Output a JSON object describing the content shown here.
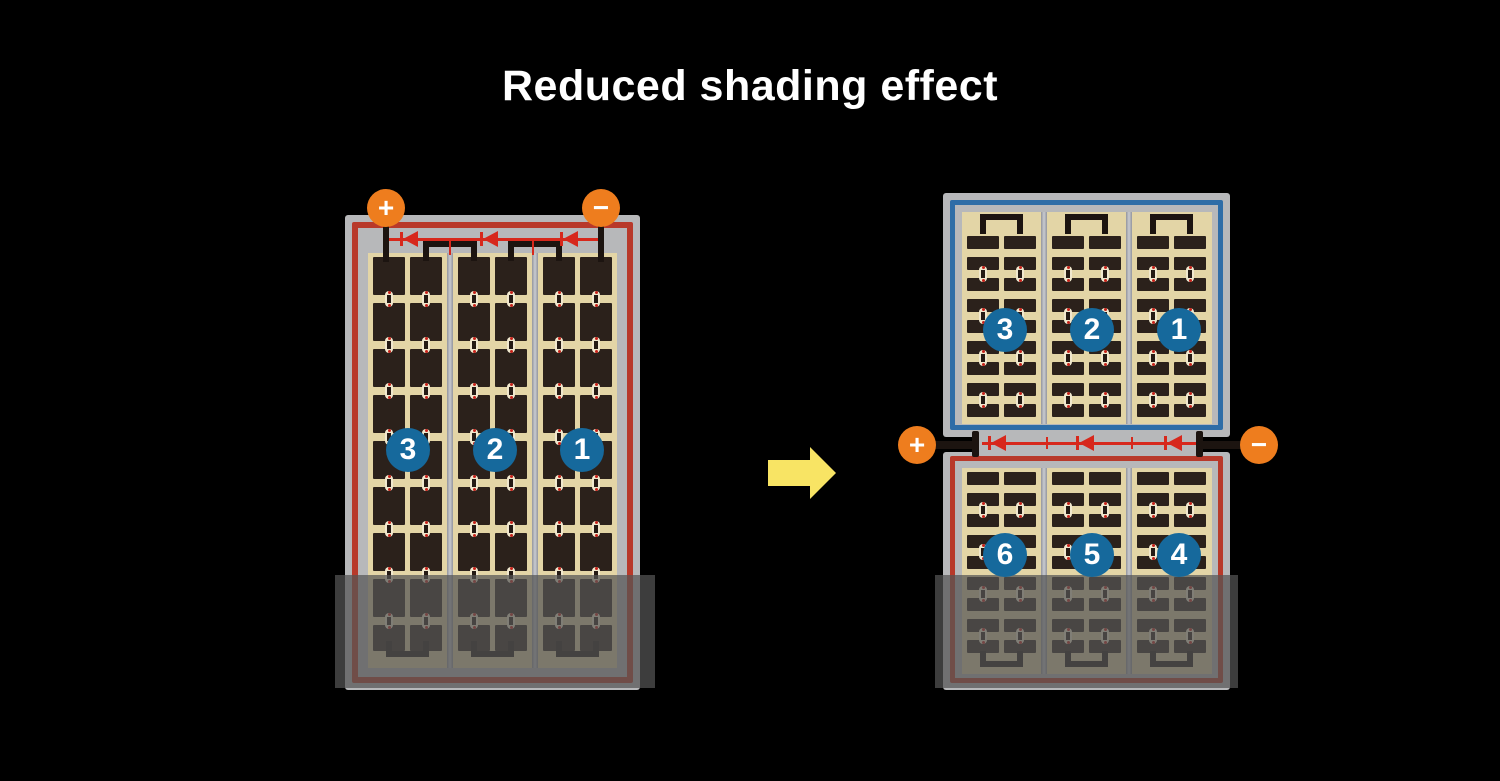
{
  "title": "Reduced shading effect",
  "colors": {
    "background": "#000000",
    "title_text": "#ffffff",
    "module_frame_gray": "#b7b8ba",
    "cell_area_tan": "#e3d5a6",
    "cell_dark": "#2b211b",
    "red_circuit_frame": "#b8392a",
    "blue_circuit_frame": "#2e6da7",
    "diode_line_red": "#d7281c",
    "string_badge_blue": "#16699c",
    "terminal_orange": "#ee7d1e",
    "arrow_yellow": "#f8e464",
    "wire_black": "#1c1410",
    "shade_overlay": "rgba(84,84,84,0.72)"
  },
  "left_module": {
    "terminals": {
      "positive": "+",
      "negative": "−"
    },
    "string_labels": [
      "3",
      "2",
      "1"
    ],
    "diode_count": 3,
    "columns": 3,
    "cell_rows": 9,
    "shaded_bottom": true
  },
  "right_module": {
    "terminals": {
      "positive": "+",
      "negative": "−"
    },
    "diode_count": 3,
    "top_panel": {
      "string_labels": [
        "3",
        "2",
        "1"
      ],
      "columns": 3,
      "cell_rows": 9,
      "shaded_bottom": false
    },
    "bottom_panel": {
      "string_labels": [
        "6",
        "5",
        "4"
      ],
      "columns": 3,
      "cell_rows": 9,
      "shaded_bottom": true
    }
  },
  "arrow": {
    "direction": "right"
  }
}
